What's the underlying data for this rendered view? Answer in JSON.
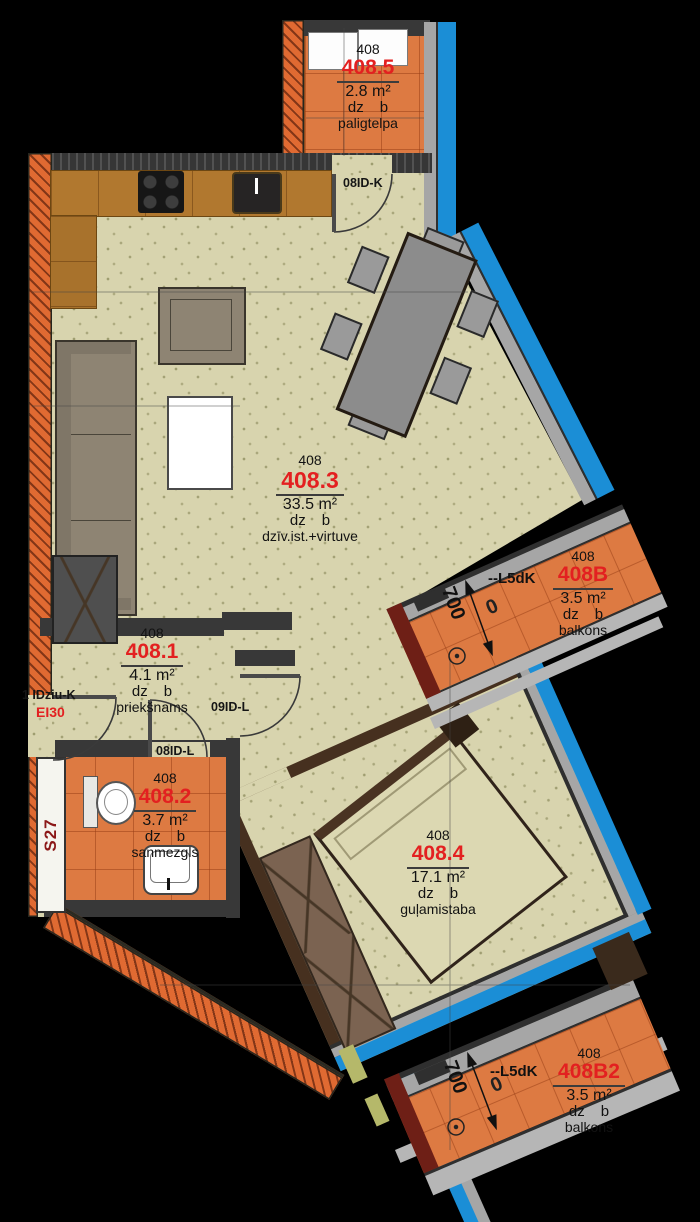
{
  "unit": "408",
  "shared": {
    "dz": "dz",
    "b": "b",
    "window_tag": "--L5dK",
    "balcony_dim": "700",
    "balcony_zero": "0"
  },
  "rooms": [
    {
      "number": "408.5",
      "area": "2.8 m²",
      "name": "paligtelpa"
    },
    {
      "number": "408.3",
      "area": "33.5 m²",
      "name": "dzīv.ist.+virtuve"
    },
    {
      "number": "408.1",
      "area": "4.1 m²",
      "name": "priekšnams"
    },
    {
      "number": "408.2",
      "area": "3.7 m²",
      "name": "sanmezgls"
    },
    {
      "number": "408.4",
      "area": "17.1 m²",
      "name": "guļamistaba"
    },
    {
      "number": "408B",
      "area": "3.5 m²",
      "name": "balkons"
    },
    {
      "number": "408B2",
      "area": "3.5 m²",
      "name": "balkons"
    }
  ],
  "doors": {
    "storage_door": "08ID-K",
    "hall_door": "09ID-L",
    "bathroom_door": "08ID-L",
    "entry_door": "1 IDziu-K",
    "entry_fire_rating": "EI30"
  },
  "shaft_label": "S27",
  "colors": {
    "accent_red": "#e32020",
    "glazing_blue": "#1b8ed6",
    "wall_orange": "#e06a32",
    "floor_beige": "#d8d4ae",
    "floor_tile_orange": "#dd7a42",
    "shaft_red": "#8b1818"
  }
}
